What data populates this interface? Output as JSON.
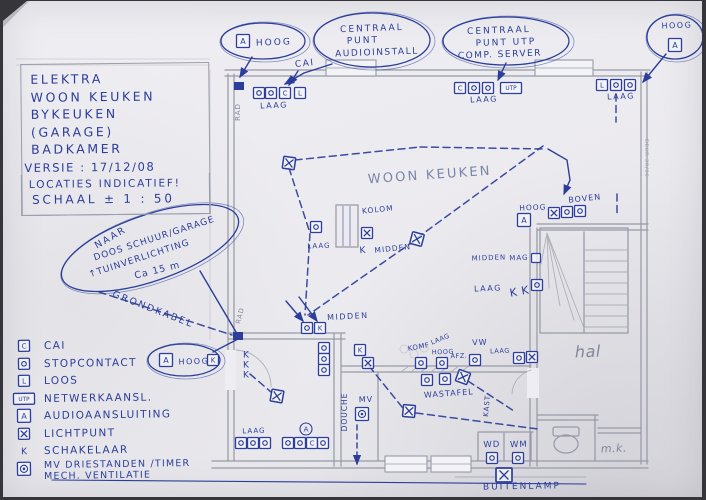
{
  "page": {
    "ink": "#2c3e9b",
    "pencil": "#83869a",
    "pencil_blue": "#7b84ac",
    "paper": "#edecf0"
  },
  "title_block": {
    "lines": [
      "ELEKTRA",
      "WOON KEUKEN",
      "BYKEUKEN",
      "(GARAGE)",
      "BADKAMER"
    ],
    "versie": "VERSIE : 17/12/08",
    "notes": [
      "LOCATIES INDICATIEF!",
      "SCHAAL ± 1 : 50"
    ]
  },
  "legend": {
    "items": [
      {
        "t": "C",
        "label": "CAI"
      },
      {
        "t": "O",
        "label": "STOPCONTACT"
      },
      {
        "t": "L",
        "label": "LOOS"
      },
      {
        "t": "UTP",
        "label": "NETWERKAANSL."
      },
      {
        "t": "A",
        "label": "AUDIOAANSLUITING"
      },
      {
        "t": "X",
        "label": "LICHTPUNT"
      },
      {
        "t": "KP",
        "label": "SCHAKELAAR"
      },
      {
        "t": "MV",
        "label": "MV DRIESTANDEN /TIMER",
        "label2": "MECH. VENTILATIE"
      }
    ]
  },
  "clouds": [
    {
      "kind": "oval",
      "cx": 263,
      "cy": 41,
      "rx": 42,
      "ry": 18,
      "lines": [
        {
          "s": "HOOG",
          "x": 274,
          "y": 45,
          "f": 9,
          "ls": 2
        }
      ],
      "abox": {
        "x": 243,
        "y": 41
      }
    },
    {
      "kind": "cloud",
      "cx": 372,
      "cy": 40,
      "rx": 58,
      "ry": 27,
      "lines": [
        {
          "s": "CENTRAAL",
          "x": 372,
          "y": 31,
          "f": 9,
          "ls": 2
        },
        {
          "s": "PUNT",
          "x": 363,
          "y": 43,
          "f": 9,
          "ls": 2
        },
        {
          "s": "AUDIOINSTALL",
          "x": 377,
          "y": 55,
          "f": 9,
          "ls": 1.5
        }
      ]
    },
    {
      "kind": "cloud",
      "cx": 506,
      "cy": 41,
      "rx": 63,
      "ry": 24,
      "lines": [
        {
          "s": "CENTRAAL",
          "x": 499,
          "y": 33,
          "f": 9,
          "ls": 2
        },
        {
          "s": "PUNT UTP",
          "x": 506,
          "y": 45,
          "f": 9,
          "ls": 2
        },
        {
          "s": "COMP. SERVER",
          "x": 500,
          "y": 57,
          "f": 9,
          "ls": 1.5
        }
      ]
    },
    {
      "kind": "oval",
      "cx": 675,
      "cy": 37,
      "rx": 28,
      "ry": 22,
      "lines": [
        {
          "s": "HOOG",
          "x": 677,
          "y": 28,
          "f": 8,
          "ls": 1.5
        }
      ],
      "abox": {
        "x": 675,
        "y": 45
      }
    },
    {
      "kind": "oval",
      "cx": 150,
      "cy": 248,
      "rx": 93,
      "ry": 33,
      "rot": -19,
      "lines": [
        {
          "s": "NAAR",
          "x": 112,
          "y": 240,
          "f": 9.5,
          "r": -30,
          "ls": 2
        },
        {
          "s": "DOOS SCHUUR/GARAGE",
          "x": 155,
          "y": 241,
          "f": 9,
          "r": -18,
          "ls": 1
        },
        {
          "s": "↑TUINVERLICHTING",
          "x": 140,
          "y": 261,
          "f": 9,
          "r": -18,
          "ls": 1
        },
        {
          "s": "Ca 15 m",
          "x": 158,
          "y": 273,
          "f": 9.5,
          "r": -14,
          "ls": 1
        }
      ]
    },
    {
      "kind": "oval",
      "cx": 184,
      "cy": 360,
      "rx": 36,
      "ry": 16,
      "lines": [
        {
          "s": "HOOG",
          "x": 194,
          "y": 364,
          "f": 8,
          "ls": 1.5
        }
      ],
      "abox": {
        "x": 166,
        "y": 360
      }
    }
  ],
  "plan": {
    "texts": [
      {
        "s": "CAI",
        "x": 305,
        "y": 66,
        "f": 9,
        "r": -6,
        "ls": 1.5
      },
      {
        "s": "LAAG",
        "x": 274,
        "y": 108,
        "f": 8,
        "ls": 1.5
      },
      {
        "s": "LAAG",
        "x": 484,
        "y": 102,
        "f": 8,
        "ls": 1.5
      },
      {
        "s": "LAAG",
        "x": 621,
        "y": 99,
        "f": 8,
        "ls": 1.5
      },
      {
        "s": "WOON KEUKEN",
        "x": 430,
        "y": 179,
        "f": 13,
        "c": "pb",
        "ls": 2.2,
        "r": -4
      },
      {
        "s": "KOLOM",
        "x": 378,
        "y": 212,
        "f": 7.5,
        "r": -6,
        "ls": 1
      },
      {
        "s": "LAAG",
        "x": 319,
        "y": 248,
        "f": 7,
        "ls": 1
      },
      {
        "s": "K",
        "x": 363,
        "y": 253,
        "f": 9,
        "r": -5
      },
      {
        "s": "MIDDEN",
        "x": 393,
        "y": 251,
        "f": 7.5,
        "r": -6,
        "ls": 1
      },
      {
        "s": "HOOG",
        "x": 533,
        "y": 210,
        "f": 7.5,
        "ls": 1
      },
      {
        "s": "BOVEN",
        "x": 585,
        "y": 201,
        "f": 8,
        "r": -6,
        "ls": 1
      },
      {
        "s": "MIDDEN",
        "x": 348,
        "y": 319,
        "f": 8,
        "r": -3,
        "ls": 1.5
      },
      {
        "s": "MIDDEN",
        "x": 489,
        "y": 260,
        "f": 7,
        "ls": 1
      },
      {
        "s": "MAG",
        "x": 519,
        "y": 260,
        "f": 7,
        "ls": 1
      },
      {
        "s": "LAAG",
        "x": 488,
        "y": 291,
        "f": 8,
        "ls": 1.5
      },
      {
        "s": "K K",
        "x": 520,
        "y": 295,
        "f": 11,
        "r": -10
      },
      {
        "s": "hal",
        "x": 588,
        "y": 357,
        "f": 16,
        "c": "pencil",
        "i": 1,
        "r": -2
      },
      {
        "s": "m.k.",
        "x": 614,
        "y": 452,
        "f": 11,
        "c": "pencil",
        "i": 1
      },
      {
        "s": "RAD",
        "x": 240,
        "y": 112,
        "f": 7,
        "c": "pencil",
        "r": -90,
        "ls": 1
      },
      {
        "s": "RAD",
        "x": 242,
        "y": 316,
        "f": 6.5,
        "c": "pencil",
        "r": -75,
        "ls": 1
      },
      {
        "s": "GRONDKABEL",
        "x": 152,
        "y": 312,
        "f": 9.5,
        "r": 21,
        "ls": 2
      },
      {
        "s": "DOUCHE",
        "x": 347,
        "y": 412,
        "f": 7.5,
        "r": -90,
        "ls": 1
      },
      {
        "s": "MV",
        "x": 366,
        "y": 402,
        "f": 8,
        "ls": 1
      },
      {
        "s": "KOMF",
        "x": 419,
        "y": 349,
        "f": 7,
        "r": -10,
        "ls": 0.5
      },
      {
        "s": "LAAG",
        "x": 441,
        "y": 341,
        "f": 6.5,
        "r": -22
      },
      {
        "s": "HOOG",
        "x": 443,
        "y": 354,
        "f": 6.5
      },
      {
        "s": "AFZ.",
        "x": 459,
        "y": 358,
        "f": 6.5
      },
      {
        "s": "VW",
        "x": 480,
        "y": 345,
        "f": 8,
        "ls": 1
      },
      {
        "s": "LAAG",
        "x": 500,
        "y": 353,
        "f": 6.5
      },
      {
        "s": "WASTAFEL",
        "x": 449,
        "y": 396,
        "f": 8,
        "r": -4,
        "ls": 1
      },
      {
        "s": "WD",
        "x": 492,
        "y": 447,
        "f": 8.5,
        "ls": 1
      },
      {
        "s": "WM",
        "x": 519,
        "y": 447,
        "f": 8.5,
        "ls": 1
      },
      {
        "s": "BUITENLAMP",
        "x": 522,
        "y": 489,
        "f": 9,
        "ls": 2,
        "r": -1
      },
      {
        "s": "KAST",
        "x": 489,
        "y": 406,
        "f": 7,
        "r": -85,
        "ls": 1
      },
      {
        "s": "LAAG",
        "x": 254,
        "y": 433,
        "f": 7,
        "ls": 1
      },
      {
        "s": "DEUR 30/30",
        "x": 645,
        "y": 158,
        "f": 5.5,
        "r": 90,
        "c": "pencilf"
      }
    ],
    "symbols": [
      {
        "t": "O",
        "x": 259,
        "y": 93
      },
      {
        "t": "O",
        "x": 271,
        "y": 93
      },
      {
        "t": "C",
        "x": 285,
        "y": 93
      },
      {
        "t": "L",
        "x": 300,
        "y": 93
      },
      {
        "t": "C",
        "x": 460,
        "y": 88
      },
      {
        "t": "O",
        "x": 474,
        "y": 88
      },
      {
        "t": "O",
        "x": 488,
        "y": 88
      },
      {
        "t": "UTP",
        "x": 511,
        "y": 88
      },
      {
        "t": "L",
        "x": 602,
        "y": 85
      },
      {
        "t": "O",
        "x": 616,
        "y": 85
      },
      {
        "t": "O",
        "x": 630,
        "y": 85
      },
      {
        "t": "X",
        "x": 554,
        "y": 213
      },
      {
        "t": "O",
        "x": 567,
        "y": 212
      },
      {
        "t": "O",
        "x": 580,
        "y": 211
      },
      {
        "t": "A",
        "x": 524,
        "y": 220
      },
      {
        "t": "S",
        "x": 536,
        "y": 258
      },
      {
        "t": "O",
        "x": 537,
        "y": 285
      },
      {
        "t": "O",
        "x": 316,
        "y": 227
      },
      {
        "t": "X",
        "x": 367,
        "y": 233
      },
      {
        "t": "XB",
        "x": 417,
        "y": 239,
        "r": 15
      },
      {
        "t": "XB",
        "x": 289,
        "y": 163,
        "r": 8
      },
      {
        "t": "XB",
        "x": 277,
        "y": 396,
        "r": 10
      },
      {
        "t": "O",
        "x": 307,
        "y": 328
      },
      {
        "t": "K",
        "x": 320,
        "y": 328
      },
      {
        "t": "O",
        "x": 324,
        "y": 348
      },
      {
        "t": "O",
        "x": 324,
        "y": 359
      },
      {
        "t": "O",
        "x": 324,
        "y": 370
      },
      {
        "t": "K",
        "x": 360,
        "y": 350
      },
      {
        "t": "X",
        "x": 368,
        "y": 363
      },
      {
        "t": "O",
        "x": 421,
        "y": 363
      },
      {
        "t": "O",
        "x": 442,
        "y": 363
      },
      {
        "t": "O",
        "x": 475,
        "y": 360
      },
      {
        "t": "O",
        "x": 519,
        "y": 358
      },
      {
        "t": "X",
        "x": 532,
        "y": 357
      },
      {
        "t": "O",
        "x": 427,
        "y": 380
      },
      {
        "t": "O",
        "x": 445,
        "y": 379
      },
      {
        "t": "XB",
        "x": 463,
        "y": 377,
        "r": 20
      },
      {
        "t": "MV",
        "x": 362,
        "y": 414
      },
      {
        "t": "XB",
        "x": 409,
        "y": 411,
        "r": 5
      },
      {
        "t": "O",
        "x": 492,
        "y": 458
      },
      {
        "t": "O",
        "x": 518,
        "y": 458
      },
      {
        "t": "XL",
        "x": 504,
        "y": 475
      },
      {
        "t": "K",
        "x": 213,
        "y": 360
      },
      {
        "t": "KP",
        "x": 246,
        "y": 354
      },
      {
        "t": "KP",
        "x": 246,
        "y": 364
      },
      {
        "t": "KP",
        "x": 246,
        "y": 374
      },
      {
        "t": "F",
        "x": 238,
        "y": 336
      },
      {
        "t": "F",
        "x": 239,
        "y": 86
      },
      {
        "t": "O",
        "x": 241,
        "y": 443
      },
      {
        "t": "O",
        "x": 253,
        "y": 443
      },
      {
        "t": "O",
        "x": 265,
        "y": 443
      },
      {
        "t": "O",
        "x": 288,
        "y": 443
      },
      {
        "t": "O",
        "x": 300,
        "y": 443
      },
      {
        "t": "C",
        "x": 312,
        "y": 443
      },
      {
        "t": "O",
        "x": 323,
        "y": 443
      },
      {
        "t": "CIRA",
        "x": 306,
        "y": 429
      }
    ],
    "dashed": [
      [
        [
          289,
          168
        ],
        [
          310,
          233
        ],
        [
          305,
          315
        ]
      ],
      [
        [
          295,
          160
        ],
        [
          420,
          147
        ]
      ],
      [
        [
          420,
          147
        ],
        [
          546,
          149
        ]
      ],
      [
        [
          417,
          238
        ],
        [
          543,
          146
        ]
      ],
      [
        [
          414,
          241
        ],
        [
          308,
          315
        ]
      ],
      [
        [
          99,
          292
        ],
        [
          232,
          335
        ]
      ],
      [
        [
          369,
          366
        ],
        [
          402,
          407
        ]
      ],
      [
        [
          416,
          413
        ],
        [
          538,
          429
        ]
      ],
      [
        [
          468,
          381
        ],
        [
          514,
          411
        ]
      ],
      [
        [
          616,
          94
        ],
        [
          616,
          122
        ]
      ],
      [
        [
          617,
          194
        ],
        [
          617,
          214
        ]
      ],
      [
        [
          250,
          374
        ],
        [
          271,
          392
        ]
      ]
    ],
    "arrows": [
      {
        "p": [
          [
            252,
            57
          ],
          [
            240,
            77
          ]
        ],
        "h": 1
      },
      {
        "p": [
          [
            332,
            64
          ],
          [
            304,
            73
          ],
          [
            285,
            84
          ]
        ],
        "h": 1
      },
      {
        "p": [
          [
            298,
            71
          ],
          [
            289,
            85
          ]
        ],
        "h": 1
      },
      {
        "p": [
          [
            506,
            63
          ],
          [
            498,
            80
          ]
        ],
        "h": 1
      },
      {
        "p": [
          [
            666,
            54
          ],
          [
            643,
            82
          ]
        ],
        "h": 1
      },
      {
        "p": [
          [
            548,
            149
          ],
          [
            567,
            160
          ],
          [
            570,
            180
          ],
          [
            564,
            194
          ]
        ],
        "h": 1
      },
      {
        "p": [
          [
            286,
            301
          ],
          [
            303,
            321
          ]
        ],
        "h": 1
      },
      {
        "p": [
          [
            299,
            297
          ],
          [
            317,
            321
          ]
        ],
        "h": 1
      },
      {
        "p": [
          [
            200,
            271
          ],
          [
            236,
            332
          ]
        ],
        "h": 0
      },
      {
        "p": [
          [
            213,
            352
          ],
          [
            238,
            339
          ]
        ],
        "h": 0
      },
      {
        "p": [
          [
            357,
            425
          ],
          [
            357,
            464
          ]
        ],
        "h": 1,
        "dash": 1
      },
      {
        "p": [
          [
            52,
            480
          ],
          [
            586,
            484
          ]
        ],
        "h": 0,
        "w": 1.1
      }
    ]
  }
}
